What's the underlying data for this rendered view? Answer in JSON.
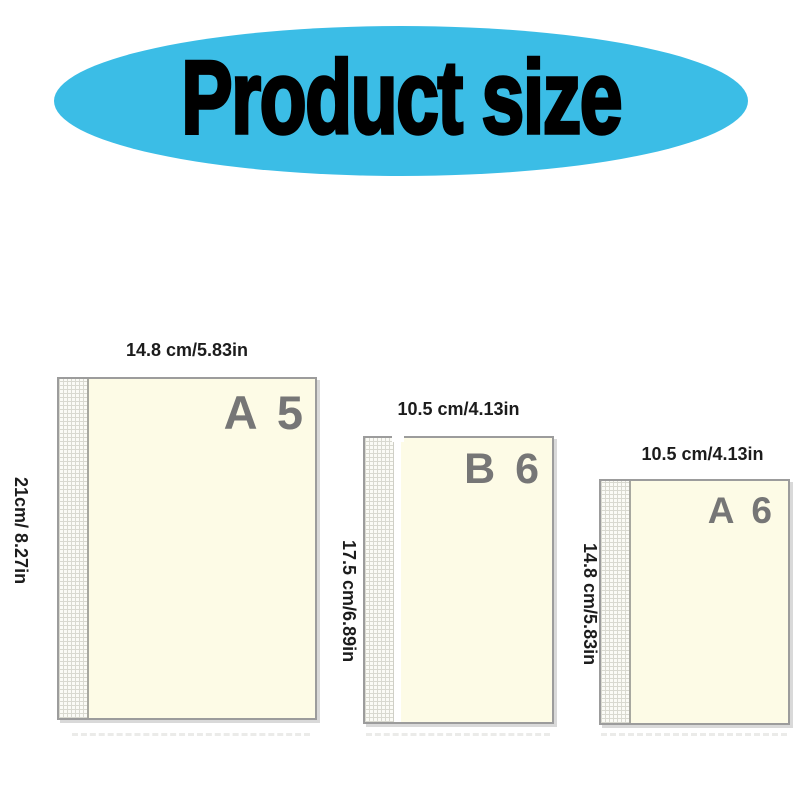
{
  "banner": {
    "title": "Product size",
    "bg_color": "#3bbde6",
    "text_color": "#000000"
  },
  "notebooks": [
    {
      "id": "a5",
      "size_label": "A 5",
      "width_label": "14.8 cm/5.83in",
      "height_label": "21cm/ 8.27in"
    },
    {
      "id": "b6",
      "size_label": "B 6",
      "width_label": "10.5 cm/4.13in",
      "height_label": "17.5 cm/6.89in"
    },
    {
      "id": "a6",
      "size_label": "A 6",
      "width_label": "10.5 cm/4.13in",
      "height_label": "14.8 cm/5.83in"
    }
  ],
  "colors": {
    "accent_blue": "#3bbde6",
    "page_cream": "#fdfbe6",
    "sheet_border": "#9c9c9c",
    "size_letter_gray": "#767676",
    "dimension_text": "#1c1c1c",
    "spine_grid_line": "#d9d9d0"
  }
}
